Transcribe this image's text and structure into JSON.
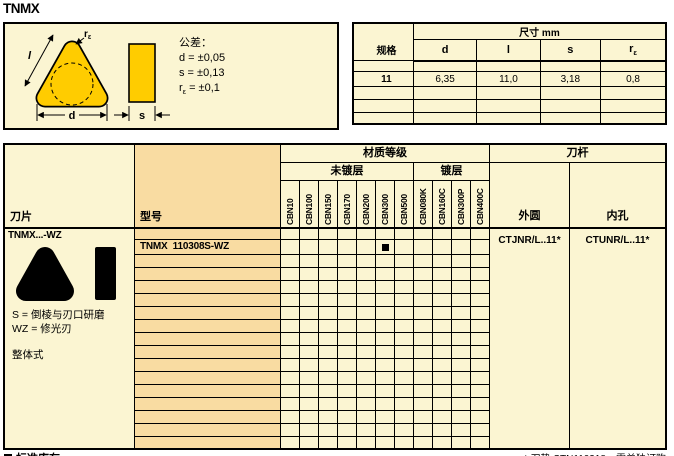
{
  "page": {
    "title": "TNMX"
  },
  "colors": {
    "cream": "#FBF5D2",
    "peach": "#F9DCA2",
    "insert_yellow": "#FFCC00",
    "ink": "#000000"
  },
  "diagram": {
    "tolerance_title": "公差：",
    "tolerance_d": "d = ±0,05",
    "tolerance_s": "s = ±0,13",
    "tolerance_r_base": "r",
    "tolerance_r_sub": "ε",
    "tolerance_r_rest": " = ±0,1",
    "label_l": "l",
    "label_d": "d",
    "label_s": "s",
    "label_r_base": "r",
    "label_r_sub": "ε"
  },
  "dim_table": {
    "group_header": "尺寸 mm",
    "spec_header": "规格",
    "col_d": "d",
    "col_l": "l",
    "col_s": "s",
    "col_r_base": "r",
    "col_r_sub": "ε",
    "row": {
      "spec": "11",
      "d": "6,35",
      "l": "11,0",
      "s": "3,18",
      "r": "0,8"
    }
  },
  "main_table": {
    "insert_header": "刀片",
    "model_header": "型号",
    "grade_group": "材质等级",
    "uncoated_group": "未镀层",
    "coated_group": "镀层",
    "uncoated_grades": [
      "CBN10",
      "CBN100",
      "CBN150",
      "CBN170",
      "CBN200",
      "CBN300",
      "CBN500"
    ],
    "coated_grades": [
      "CBN080K",
      "CBN160C",
      "CBN300P",
      "CBN400C"
    ],
    "holder_group": "刀杆",
    "holder_external_header": "外圆",
    "holder_internal_header": "内孔",
    "insert_info": {
      "title": "TNMX...-WZ",
      "note_s": "S = 倒棱与刃口研磨",
      "note_wz": "WZ = 修光刃",
      "construction": "整体式"
    },
    "body": {
      "total_rows": 17,
      "model_row_index": 1,
      "model": "TNMX  110308S-WZ",
      "stocked_grade": "CBN300",
      "stocked_col_index": 5,
      "holder_external": "CTJNR/L..11*",
      "holder_internal": "CTUNR/L..11*"
    }
  },
  "footer": {
    "legend_marker": "■",
    "legend_label": "标准库存",
    "footnote": "* 刀垫 STN110318，需单独订购"
  }
}
